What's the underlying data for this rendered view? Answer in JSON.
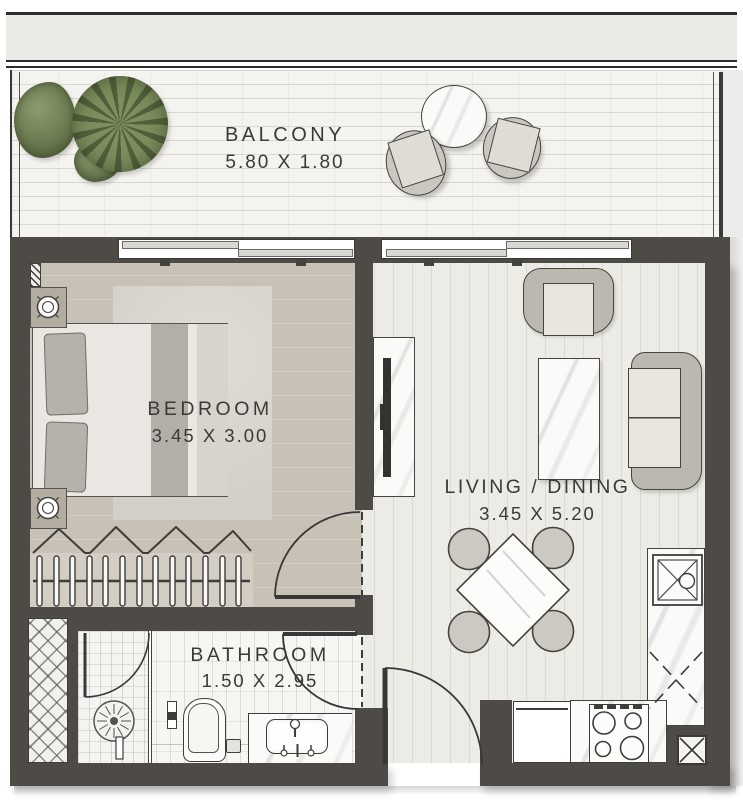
{
  "rooms": {
    "balcony": {
      "name": "BALCONY",
      "dims": "5.80 X 1.80"
    },
    "bedroom": {
      "name": "BEDROOM",
      "dims": "3.45 X 3.00"
    },
    "living": {
      "name": "LIVING / DINING",
      "dims": "3.45 X 5.20"
    },
    "bathroom": {
      "name": "BATHROOM",
      "dims": "1.50 X 2.95"
    }
  },
  "palette": {
    "wall": "#4e4b47",
    "text": "#3b3a37",
    "bedroom_floor": "#c8c1b6",
    "living_floor": "#edebe5",
    "balcony_floor": "#f4f3ef",
    "bathroom_floor": "#f7f6f2",
    "furniture_gray": "#bab8af",
    "plant_green": "#6b7b4e",
    "marble": "#fafaf8"
  }
}
